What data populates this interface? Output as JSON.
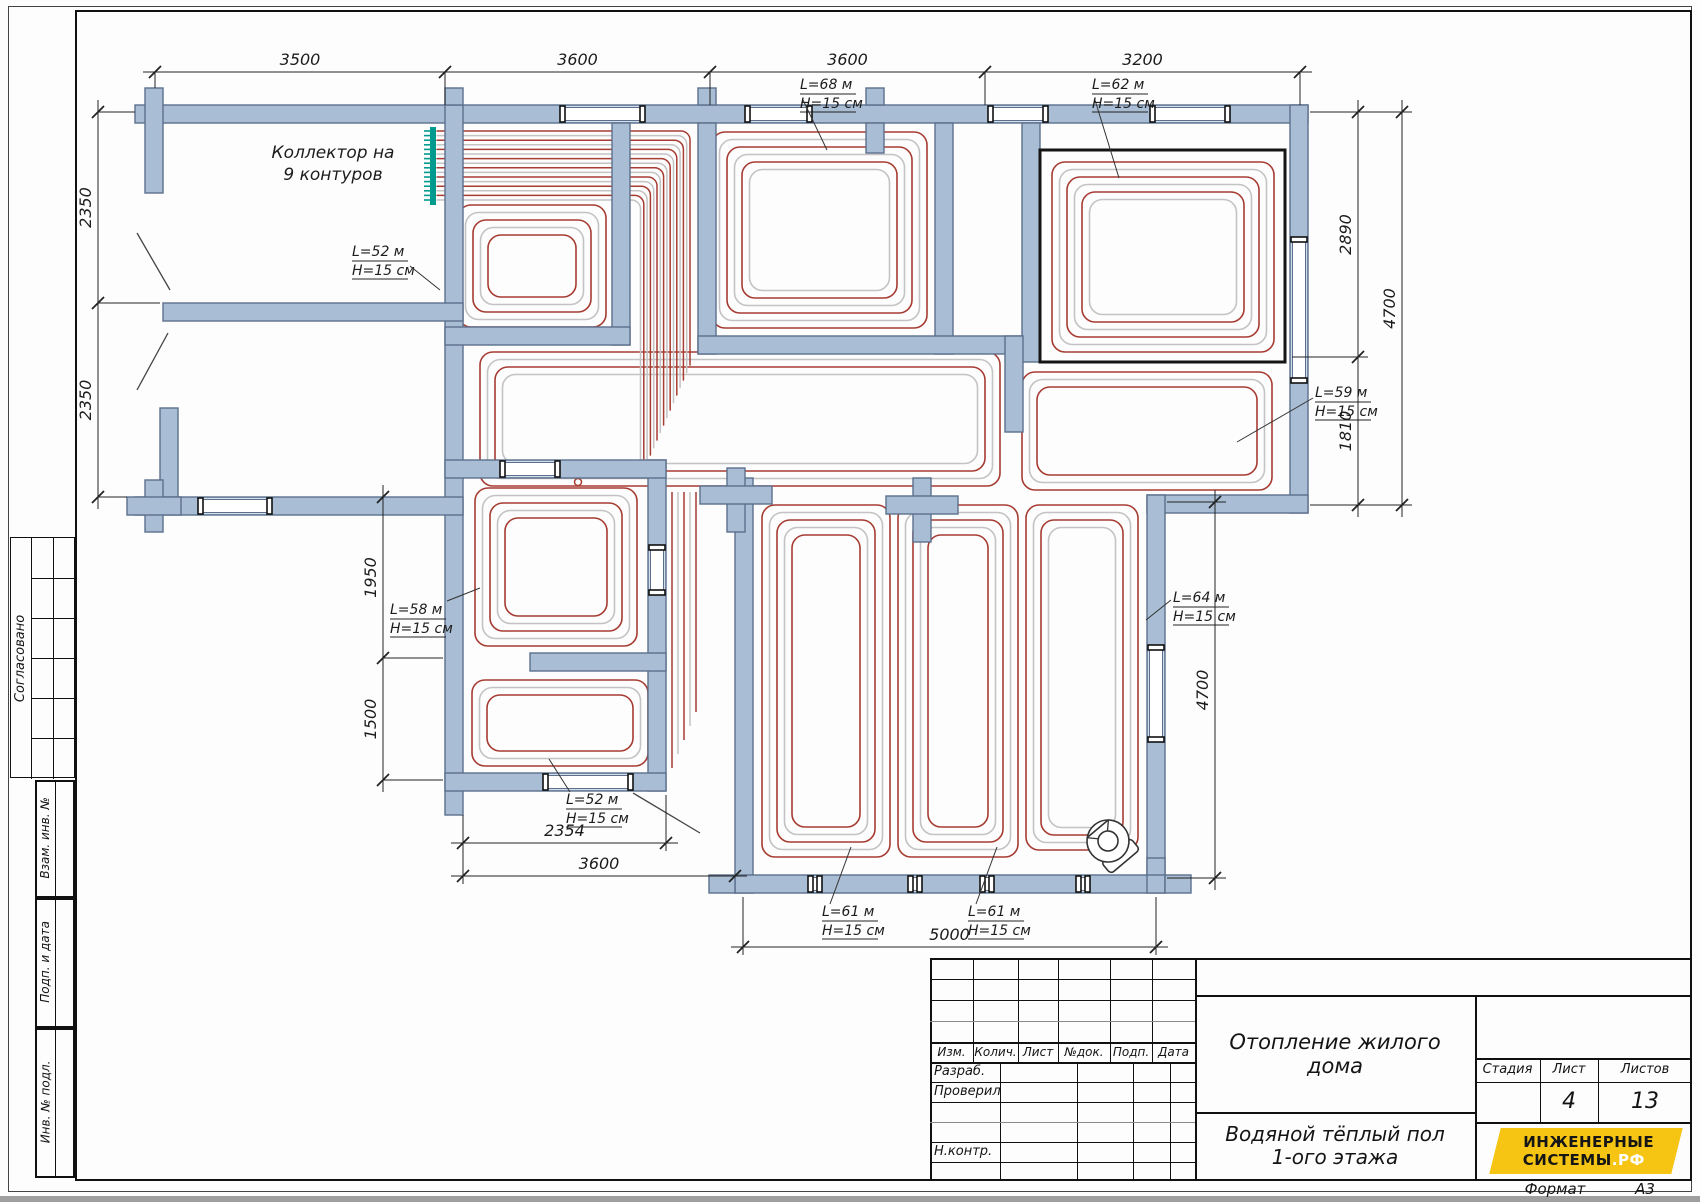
{
  "sheet": {
    "format_label": "Формат",
    "format_value": "А3"
  },
  "sidebar": {
    "approved_label": "Согласовано",
    "stamp_labels": [
      "Взам. инв. №",
      "Подп. и дата",
      "Инв. № подл."
    ]
  },
  "plan": {
    "collector_label_line1": "Коллектор на",
    "collector_label_line2": "9 контуров",
    "circuits": [
      {
        "length": "L=52 м",
        "spacing": "H=15 см"
      },
      {
        "length": "L=68 м",
        "spacing": "H=15 см"
      },
      {
        "length": "L=62 м",
        "spacing": "H=15 см"
      },
      {
        "length": "L=59 м",
        "spacing": "H=15 см"
      },
      {
        "length": "L=58 м",
        "spacing": "H=15 см"
      },
      {
        "length": "L=52 м",
        "spacing": "H=15 см"
      },
      {
        "length": "L=61 м",
        "spacing": "H=15 см"
      },
      {
        "length": "L=61 м",
        "spacing": "H=15 см"
      },
      {
        "length": "L=64 м",
        "spacing": "H=15 см"
      }
    ],
    "dimensions": {
      "top": [
        "3500",
        "3600",
        "3600",
        "3200"
      ],
      "left": [
        "2350",
        "2350"
      ],
      "left_inner": [
        "1950",
        "1500"
      ],
      "bottom_inner": [
        "2354",
        "3600"
      ],
      "bottom": [
        "5000"
      ],
      "right": [
        "2890",
        "1810"
      ],
      "right_outer": [
        "4700"
      ],
      "right_lower": [
        "4700"
      ]
    }
  },
  "titleblock": {
    "revision_headers": [
      "Изм.",
      "Колич.",
      "Лист",
      "№док.",
      "Подп.",
      "Дата"
    ],
    "role_labels": [
      "Разраб.",
      "Проверил",
      "Н.контр."
    ],
    "project_title_line1": "Отопление жилого",
    "project_title_line2": "дома",
    "sheet_title_line1": "Водяной тёплый пол",
    "sheet_title_line2": "1-ого этажа",
    "stage_label": "Стадия",
    "sheet_label": "Лист",
    "sheets_label": "Листов",
    "sheet_number": "4",
    "sheets_total": "13",
    "logo_line1": "ИНЖЕНЕРНЫЕ",
    "logo_line2": "СИСТЕМЫ",
    "logo_suffix": ".РФ"
  },
  "colors": {
    "wall_fill": "#a9bdd4",
    "wall_stroke": "#5c6f8c",
    "pipe_supply": "#a63c32",
    "pipe_return": "#c3c3c3",
    "collector": "#009a8e",
    "logo_bg": "#f6c514",
    "highlight": "#151515"
  }
}
